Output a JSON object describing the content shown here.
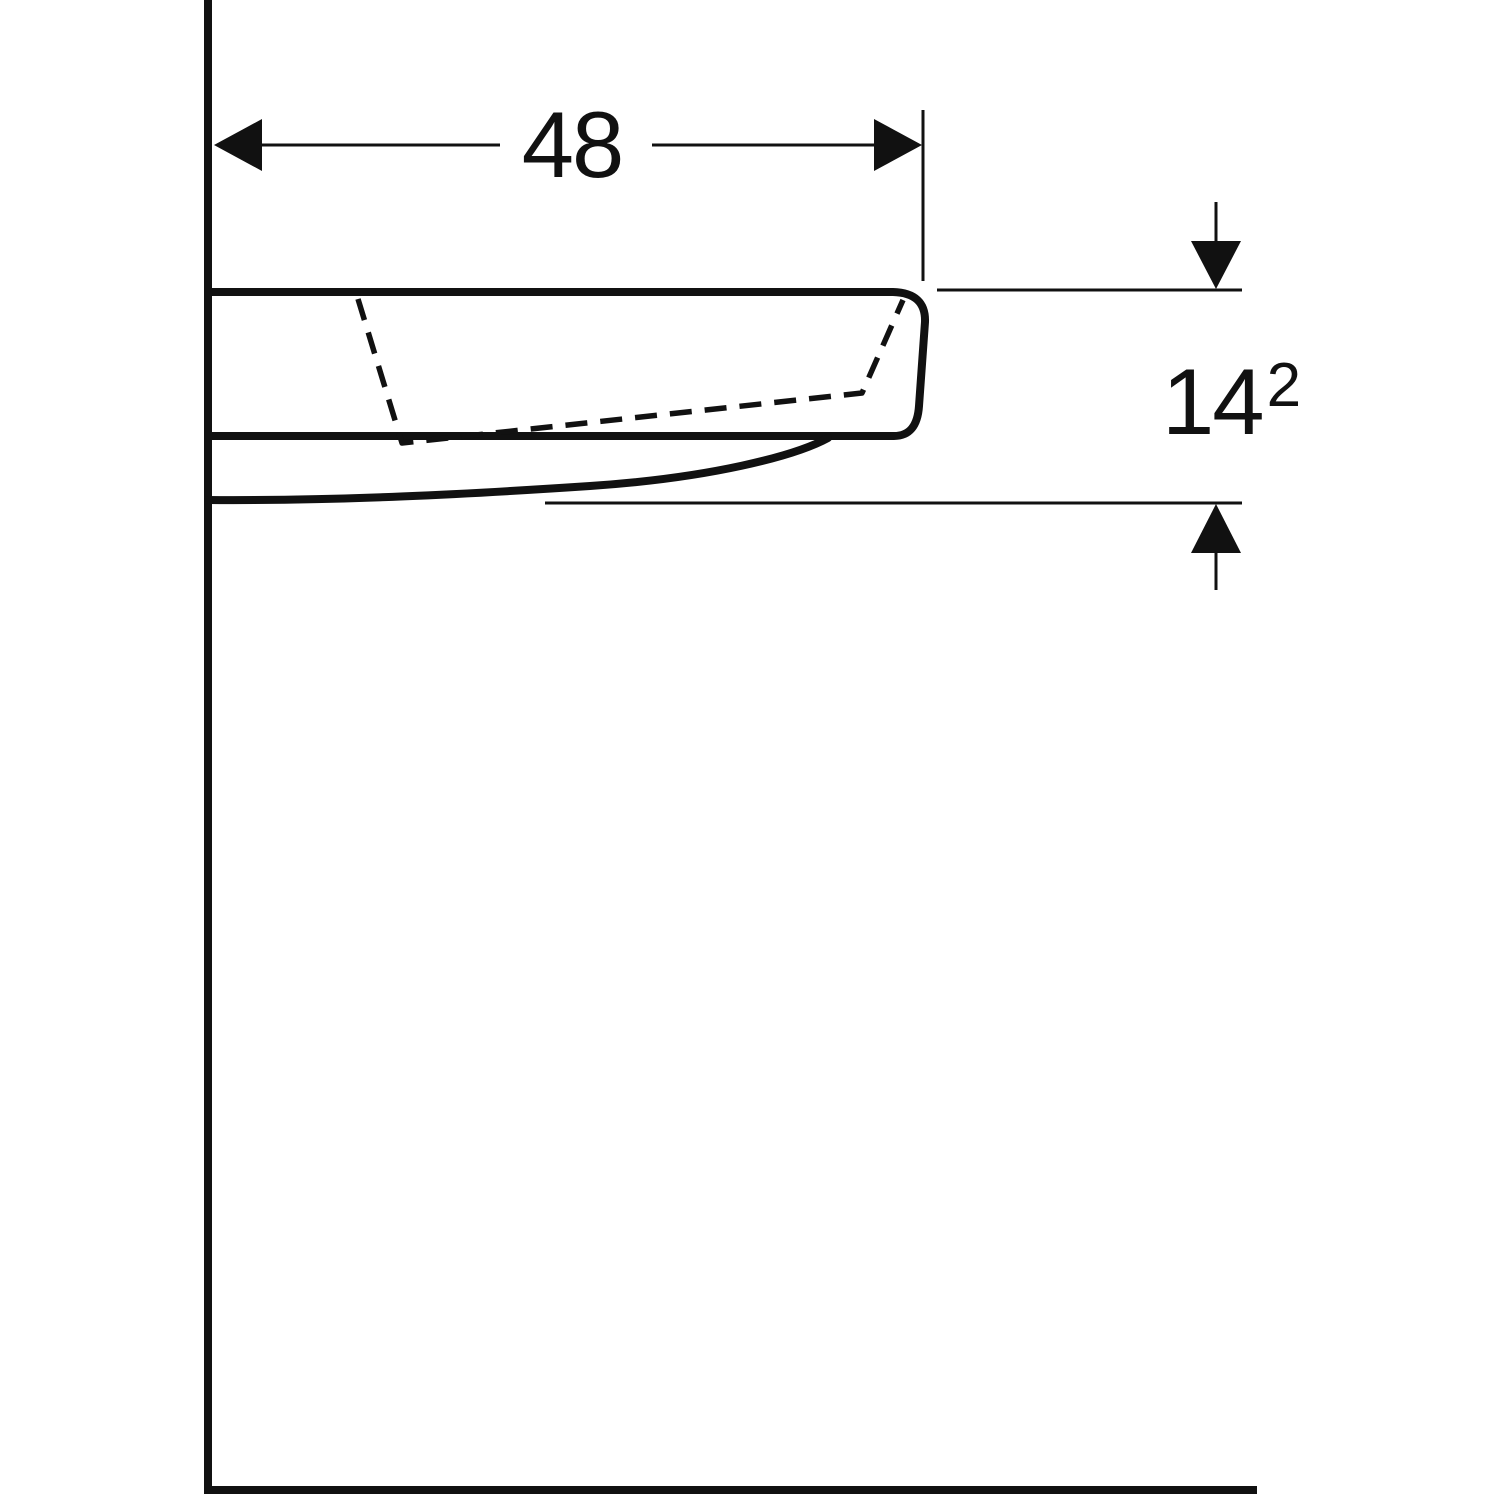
{
  "colors": {
    "line": "#111111",
    "background": "#ffffff"
  },
  "dimensions": {
    "width": {
      "value": "48"
    },
    "height": {
      "value": "14",
      "superscript": "2"
    }
  }
}
